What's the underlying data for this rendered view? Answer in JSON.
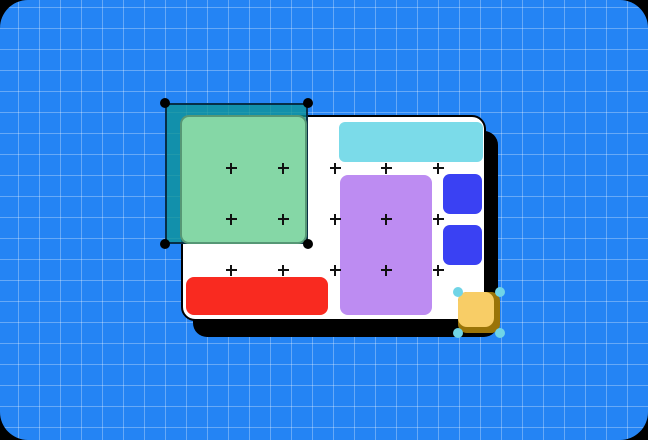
{
  "scene": {
    "background": {
      "name": "blueprint-grid-background",
      "fill": "#2484F4",
      "grid_line": "rgba(255,255,255,0.30)",
      "grid_size": 21,
      "corner_backdrop": "#000000",
      "corner_radius": 28
    },
    "artboard": {
      "name": "artboard-page",
      "x": 181,
      "y": 115,
      "w": 305,
      "h": 206,
      "r": 14,
      "fill": "#FFFFFF",
      "border": "#000000",
      "shadow": "#000000",
      "shadow_dx": 12,
      "shadow_dy": 16
    },
    "shapes": [
      {
        "name": "sky-blue-bar",
        "color": "#7BDBE9",
        "x": 339,
        "y": 122,
        "w": 144,
        "h": 40,
        "r": 6
      },
      {
        "name": "purple-rect",
        "color": "#BD8CF2",
        "x": 340,
        "y": 175,
        "w": 92,
        "h": 140,
        "r": 8
      },
      {
        "name": "indigo-square-top",
        "color": "#3A41F3",
        "x": 443,
        "y": 174,
        "w": 39,
        "h": 40,
        "r": 7
      },
      {
        "name": "indigo-square-bottom",
        "color": "#3A41F3",
        "x": 443,
        "y": 225,
        "w": 39,
        "h": 40,
        "r": 7
      },
      {
        "name": "red-bar",
        "color": "#F92A20",
        "x": 186,
        "y": 277,
        "w": 142,
        "h": 38,
        "r": 8
      }
    ],
    "cross_markers": {
      "color": "#111111",
      "cols": [
        231,
        283,
        335,
        386,
        438
      ],
      "rows": [
        168,
        219,
        270
      ],
      "size": 11
    },
    "green_selection": {
      "marquee": {
        "x": 165,
        "y": 103,
        "w": 143,
        "h": 141,
        "fill": "rgba(13,148,150,0.78)",
        "border": "rgba(5,35,60,0.9)"
      },
      "shape": {
        "name": "green-square",
        "color": "#85D7A6",
        "x": 180,
        "y": 115,
        "w": 127,
        "h": 129,
        "r": 9,
        "border": "rgba(15,55,45,0.4)"
      },
      "handle": {
        "color": "#000000",
        "d": 10
      },
      "handle_positions": [
        [
          165,
          103
        ],
        [
          308,
          103
        ],
        [
          165,
          244
        ],
        [
          308,
          244
        ]
      ]
    },
    "yellow_selection": {
      "shape": {
        "name": "yellow-square",
        "outer_color": "#9A7408",
        "inner_color": "#F8CD66",
        "x": 458,
        "y": 292,
        "w": 42,
        "h": 41,
        "r": 9,
        "inner_w": 36,
        "inner_h": 35
      },
      "handle": {
        "color": "#70D4E6",
        "d": 10
      },
      "handle_positions": [
        [
          458,
          292
        ],
        [
          500,
          292
        ],
        [
          458,
          333
        ],
        [
          500,
          333
        ]
      ]
    }
  }
}
